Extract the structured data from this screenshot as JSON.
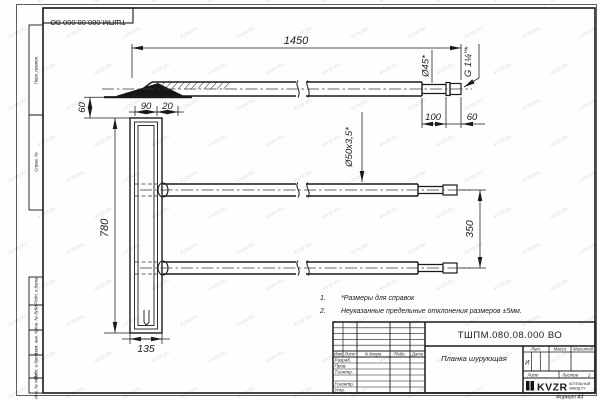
{
  "sheet": {
    "stamp_top": "ТШПМ.080.08.000 ВО",
    "watermark": "KVZR.RU",
    "format": "Формат А3"
  },
  "frame_labels": [
    "Перв. примен.",
    "Справ. №",
    "Подп. и дата",
    "Инв. № дубл.",
    "Взам. инв. №",
    "Подп. и дата",
    "Инв. № подл."
  ],
  "dims": {
    "len": "1450",
    "h60": "60",
    "w90": "90",
    "w20": "20",
    "plank_h": "780",
    "plank_w": "135",
    "gap350": "350",
    "end100": "100",
    "end60": "60",
    "dia45": "Ø45*",
    "thread": "G 1¼\"*",
    "pipe": "Ø50х3,5*"
  },
  "notes": {
    "n1": "1.",
    "t1": "*Размеры для справок",
    "n2": "2.",
    "t2": "Неуказанные предельные отклонения размеров ±5мм."
  },
  "tb": {
    "designation": "ТШПМ.080.08.000 ВО",
    "name": "Планка шурующая",
    "h_izm": "Изм",
    "h_list": "Лист",
    "h_doc": "N докум.",
    "h_podp": "Подп.",
    "h_data": "Дата",
    "r1": "Разраб.",
    "r2": "Пров.",
    "r3": "Т.контр.",
    "r4": "Н.контр.",
    "r5": "Утв.",
    "lit": "Лит.",
    "mass": "Масса",
    "scale": "Масштаб",
    "lit_val": "И",
    "sheet": "Лист",
    "sheets": "Листов",
    "sheets_val": "1",
    "logo": "KVZR",
    "logo_s1": "КОТЕЛЬНЫЙ",
    "logo_s2": "ЗАВОД РУ"
  }
}
